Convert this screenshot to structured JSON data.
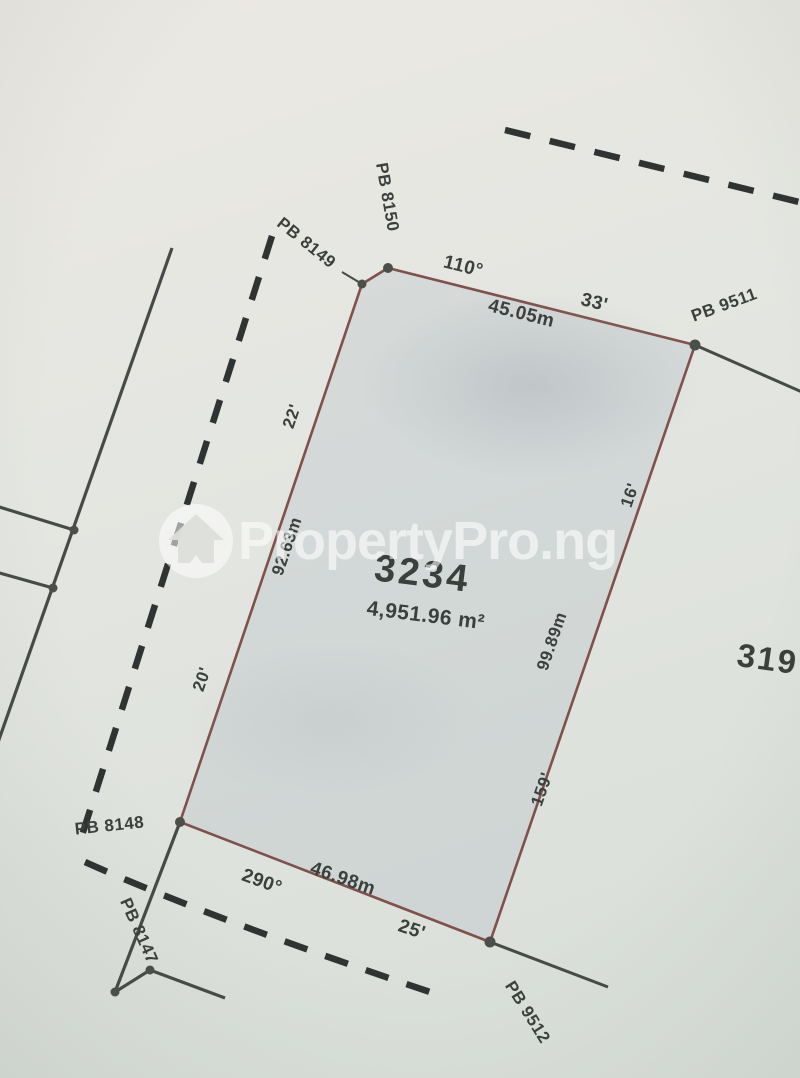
{
  "brand_watermark": {
    "text": "PropertyPro.ng",
    "logo": "house-circle-icon"
  },
  "survey_plan": {
    "parcel": {
      "plot_number": "3234",
      "area": "4,951.96 m²"
    },
    "adjacent_plot_number": "319",
    "beacons": {
      "pb_8150": "PB 8150",
      "pb_8149": "PB 8149",
      "pb_9511": "PB 9511",
      "pb_8148": "PB 8148",
      "pb_8147": "PB 8147",
      "pb_9512": "PB 9512"
    },
    "edges": {
      "top": {
        "bearing_degrees": "110°",
        "bearing_minutes": "33'",
        "length": "45.05m"
      },
      "right": {
        "bearing_minutes": "16'",
        "length": "99.89m",
        "bearing_lower": "159'"
      },
      "bottom": {
        "bearing_degrees": "290°",
        "bearing_minutes": "25'",
        "length": "46.98m"
      },
      "left": {
        "bearing_minutes_upper": "22'",
        "length": "92.63m",
        "bearing_minutes_lower": "20'"
      }
    }
  },
  "colors": {
    "paper": "#e7e8e3",
    "parcel_line": "#80514b",
    "ink": "#3b403d",
    "dashed_line": "#2f3331",
    "watermark": "#ffffff"
  }
}
